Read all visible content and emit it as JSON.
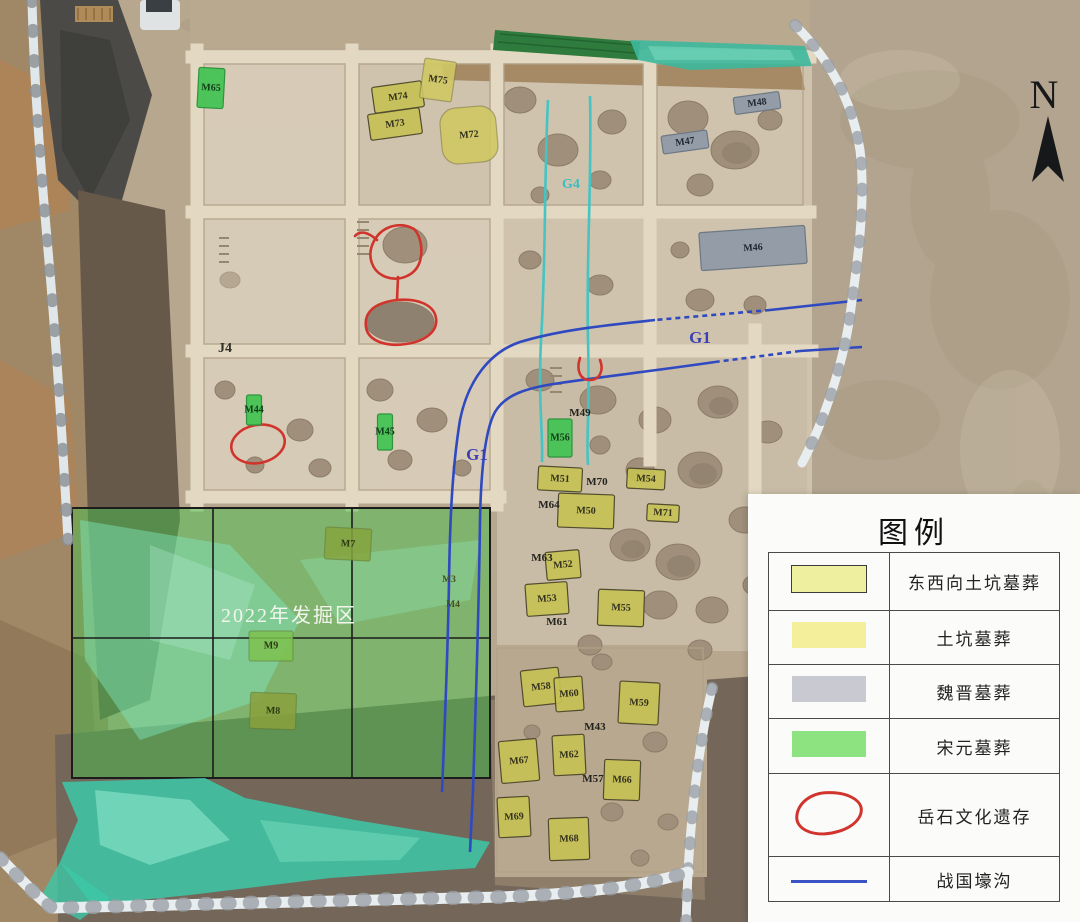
{
  "map": {
    "tombs": [
      {
        "id": "M74",
        "type": "ew",
        "x": 398,
        "y": 97,
        "w": 50,
        "h": 26,
        "rot": -8
      },
      {
        "id": "M73",
        "type": "ew",
        "x": 395,
        "y": 124,
        "w": 52,
        "h": 26,
        "rot": -8
      },
      {
        "id": "M75",
        "type": "pit",
        "x": 438,
        "y": 80,
        "w": 32,
        "h": 40,
        "rot": 8
      },
      {
        "id": "M72",
        "type": "pit",
        "x": 469,
        "y": 135,
        "w": 56,
        "h": 56,
        "rot": -5,
        "rx": 16
      },
      {
        "id": "M65",
        "type": "green",
        "x": 211,
        "y": 88,
        "w": 26,
        "h": 40,
        "rot": 3
      },
      {
        "id": "M48",
        "type": "weijin",
        "x": 757,
        "y": 103,
        "w": 46,
        "h": 17,
        "rot": -8
      },
      {
        "id": "M47",
        "type": "weijin",
        "x": 685,
        "y": 142,
        "w": 46,
        "h": 18,
        "rot": -8
      },
      {
        "id": "M46",
        "type": "weijin",
        "x": 753,
        "y": 248,
        "w": 106,
        "h": 38,
        "rot": -4
      },
      {
        "id": "M44",
        "type": "green",
        "x": 254,
        "y": 410,
        "w": 15,
        "h": 30,
        "rot": 0
      },
      {
        "id": "M45",
        "type": "green",
        "x": 385,
        "y": 432,
        "w": 15,
        "h": 36,
        "rot": 0
      },
      {
        "id": "M56",
        "type": "green",
        "x": 560,
        "y": 438,
        "w": 24,
        "h": 38,
        "rot": 0
      },
      {
        "id": "M51",
        "type": "ew",
        "x": 560,
        "y": 479,
        "w": 44,
        "h": 24,
        "rot": 3
      },
      {
        "id": "M54",
        "type": "ew",
        "x": 646,
        "y": 479,
        "w": 38,
        "h": 20,
        "rot": 3
      },
      {
        "id": "M50",
        "type": "ew",
        "x": 586,
        "y": 511,
        "w": 56,
        "h": 34,
        "rot": 2
      },
      {
        "id": "M71",
        "type": "ew",
        "x": 663,
        "y": 513,
        "w": 32,
        "h": 17,
        "rot": 3
      },
      {
        "id": "M52",
        "type": "ew",
        "x": 563,
        "y": 565,
        "w": 34,
        "h": 28,
        "rot": -5
      },
      {
        "id": "M53",
        "type": "ew",
        "x": 547,
        "y": 599,
        "w": 42,
        "h": 32,
        "rot": -4
      },
      {
        "id": "M55",
        "type": "ew",
        "x": 621,
        "y": 608,
        "w": 46,
        "h": 36,
        "rot": 2
      },
      {
        "id": "M58",
        "type": "ew",
        "x": 541,
        "y": 687,
        "w": 38,
        "h": 36,
        "rot": -6
      },
      {
        "id": "M60",
        "type": "ew",
        "x": 569,
        "y": 694,
        "w": 28,
        "h": 34,
        "rot": -4
      },
      {
        "id": "M59",
        "type": "ew",
        "x": 639,
        "y": 703,
        "w": 40,
        "h": 42,
        "rot": 3
      },
      {
        "id": "M62",
        "type": "ew",
        "x": 569,
        "y": 755,
        "w": 32,
        "h": 40,
        "rot": -3
      },
      {
        "id": "M66",
        "type": "ew",
        "x": 622,
        "y": 780,
        "w": 36,
        "h": 40,
        "rot": 2
      },
      {
        "id": "M67",
        "type": "ew",
        "x": 519,
        "y": 761,
        "w": 38,
        "h": 42,
        "rot": -5
      },
      {
        "id": "M69",
        "type": "ew",
        "x": 514,
        "y": 817,
        "w": 32,
        "h": 40,
        "rot": -3
      },
      {
        "id": "M68",
        "type": "ew",
        "x": 569,
        "y": 839,
        "w": 40,
        "h": 42,
        "rot": -2
      },
      {
        "id": "M7",
        "type": "area",
        "x": 348,
        "y": 544,
        "w": 46,
        "h": 32,
        "rot": 3,
        "fill": "#86a33e"
      },
      {
        "id": "M9",
        "type": "area",
        "x": 271,
        "y": 646,
        "w": 44,
        "h": 30,
        "rot": 0,
        "fill": "#7cc24f"
      },
      {
        "id": "M8",
        "type": "area",
        "x": 273,
        "y": 711,
        "w": 46,
        "h": 36,
        "rot": 2,
        "fill": "#8aa03c"
      }
    ],
    "labels": [
      {
        "text": "J4",
        "name": "trench-j4",
        "style": "dark",
        "x": 225,
        "y": 352
      },
      {
        "text": "M49",
        "name": "tomb-m49",
        "style": "black",
        "x": 580,
        "y": 416
      },
      {
        "text": "M70",
        "name": "tomb-m70",
        "style": "black",
        "x": 597,
        "y": 485
      },
      {
        "text": "M64",
        "name": "tomb-m64",
        "style": "black",
        "x": 549,
        "y": 508
      },
      {
        "text": "M63",
        "name": "tomb-m63",
        "style": "black",
        "x": 542,
        "y": 561
      },
      {
        "text": "M61",
        "name": "tomb-m61",
        "style": "black",
        "x": 557,
        "y": 625
      },
      {
        "text": "M43",
        "name": "tomb-m43",
        "style": "black",
        "x": 595,
        "y": 730
      },
      {
        "text": "M57",
        "name": "tomb-m57",
        "style": "black",
        "x": 593,
        "y": 782
      },
      {
        "text": "M3",
        "name": "tomb-m3",
        "style": "olive",
        "x": 449,
        "y": 582
      },
      {
        "text": "M4",
        "name": "tomb-m4",
        "style": "olive",
        "x": 453,
        "y": 607
      },
      {
        "text": "G1",
        "name": "ditch-g1-east",
        "style": "blue",
        "x": 700,
        "y": 343
      },
      {
        "text": "G1",
        "name": "ditch-g1-west",
        "style": "blue",
        "x": 477,
        "y": 460
      },
      {
        "text": "G4",
        "name": "ditch-g4",
        "style": "cyan",
        "x": 571,
        "y": 188
      },
      {
        "text": "2022年发掘区",
        "name": "excavation-area-2022",
        "style": "white",
        "x": 289,
        "y": 622
      },
      {
        "text": "N",
        "name": "north-letter",
        "style": "north",
        "x": 1044,
        "y": 108
      }
    ]
  },
  "legend": {
    "title": "图例",
    "rows": [
      {
        "swatch": "east-west-pit-tomb",
        "label": "东西向土坑墓葬"
      },
      {
        "swatch": "pit-tomb",
        "label": "土坑墓葬"
      },
      {
        "swatch": "weijin-tomb",
        "label": "魏晋墓葬"
      },
      {
        "swatch": "songyuan-tomb",
        "label": "宋元墓葬"
      },
      {
        "swatch": "yueshi-remains",
        "label": "岳石文化遗存"
      },
      {
        "swatch": "zhanguo-ditch",
        "label": "战国壕沟"
      }
    ]
  },
  "colors": {
    "east_west_tomb": "#c6c155",
    "pit_tomb": "#f4ef9b",
    "weijin_tomb": "#8f9aa7",
    "songyuan_tomb": "#44c353",
    "yueshi_red": "#d0342c",
    "zhanguo_blue": "#3a52c4",
    "g4_cyan": "#35bfc4",
    "overlay_green": "#49bf4d",
    "netting_teal": "#3cc8a8",
    "terrain_tan": "#b7a78f"
  }
}
